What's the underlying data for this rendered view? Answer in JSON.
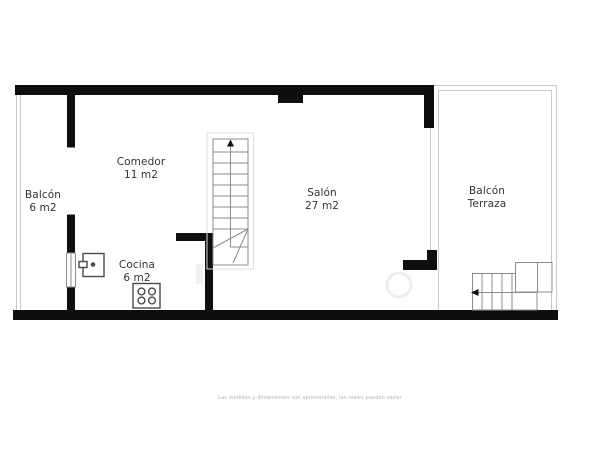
{
  "plan": {
    "rooms": [
      {
        "id": "balcon",
        "name": "Balcón",
        "area": "6 m2"
      },
      {
        "id": "comedor",
        "name": "Comedor",
        "area": "11 m2"
      },
      {
        "id": "cocina",
        "name": "Cocina",
        "area": "6 m2"
      },
      {
        "id": "salon",
        "name": "Salón",
        "area": "27 m2"
      },
      {
        "id": "balcon-terraza",
        "name": "Balcón",
        "area": "Terraza"
      }
    ],
    "disclaimer": "Las medidas y dimensiones son aproximadas, las reales pueden variar",
    "icons": [
      {
        "name": "interior-stairs-icon",
        "meaning": "staircase going up (arrow up)"
      },
      {
        "name": "exterior-stairs-icon",
        "meaning": "terrace staircase (arrow left)"
      },
      {
        "name": "sink-icon",
        "meaning": "kitchen sink"
      },
      {
        "name": "stove-icon",
        "meaning": "4-burner stove"
      },
      {
        "name": "window-symbol",
        "meaning": "window in wall"
      }
    ],
    "colors": {
      "wall": "#0e0e0e",
      "thin_line": "#8c8c8c",
      "light_line": "#c9c9c9",
      "outer_line": "#dedede",
      "fixture_line": "#4a4a4a",
      "text": "#333333",
      "muted": "#b3b3b3",
      "watermark": "#ededed",
      "background": "#ffffff"
    }
  }
}
